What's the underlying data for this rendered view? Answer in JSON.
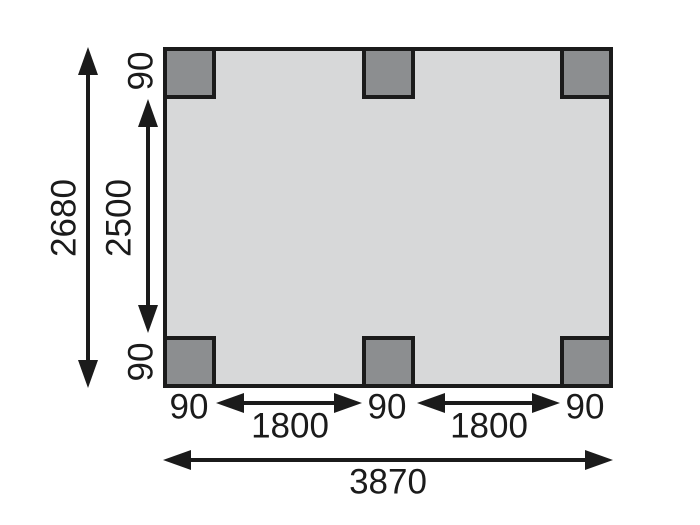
{
  "colors": {
    "background": "#ffffff",
    "plan_fill": "#d7d8d9",
    "post_fill": "#8c8e90",
    "line": "#1b1b1b"
  },
  "dims": {
    "overall_height": "2680",
    "inner_height": "2500",
    "post_side_top": "90",
    "post_side_bottom": "90",
    "bottom_row": [
      "90",
      "1800",
      "90",
      "1800",
      "90"
    ],
    "overall_width": "3870"
  }
}
